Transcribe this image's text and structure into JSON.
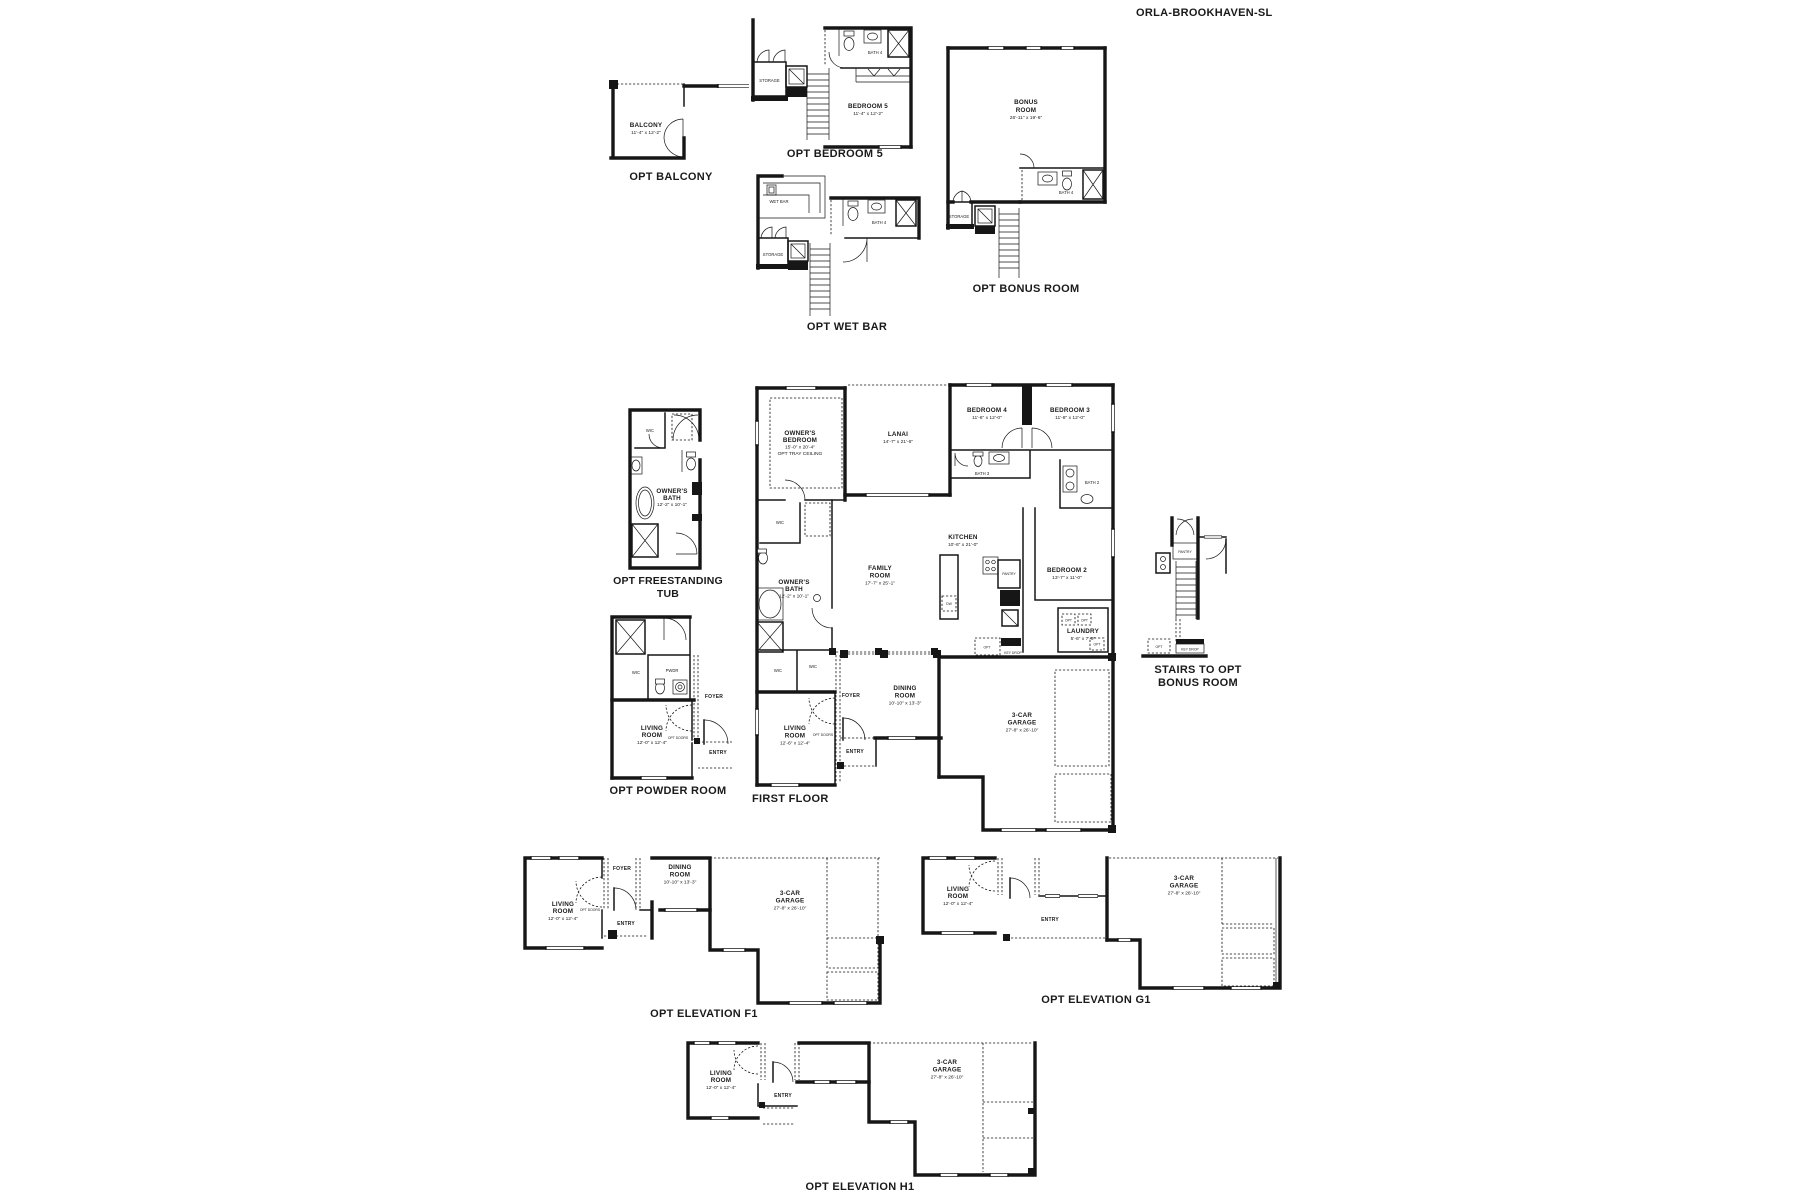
{
  "title": "ORLA-BROOKHAVEN-SL",
  "shared": {
    "storage": "STORAGE",
    "wic": "WIC",
    "opt": "OPT",
    "opt_doors": "OPT DOORS",
    "foyer": "FOYER",
    "entry": "ENTRY",
    "pantry": "PANTRY",
    "key_drop": "KEY DROP",
    "dw": "DW",
    "bath2": "BATH 2",
    "bath3": "BATH 3",
    "bath4": "BATH 4",
    "living1": "LIVING",
    "living2": "ROOM",
    "living_dims": "12'-0\" x 12'-4\"",
    "dining1": "DINING",
    "dining2": "ROOM",
    "dining_dims": "10'-10\" x 13'-3\"",
    "garage1": "3-CAR",
    "garage2": "GARAGE",
    "garage_dims": "27'-8\" x 26'-10\""
  },
  "sections": {
    "balcony": {
      "caption": "OPT BALCONY",
      "room": "BALCONY",
      "dims": "11'-4\" x 12'-2\""
    },
    "bedroom5": {
      "caption": "OPT BEDROOM 5",
      "room": "BEDROOM 5",
      "dims": "11'-4\" x 12'-2\""
    },
    "wetbar": {
      "caption": "OPT WET BAR",
      "room": "WET BAR"
    },
    "bonus": {
      "caption": "OPT BONUS ROOM",
      "room1": "BONUS",
      "room2": "ROOM",
      "dims": "26'-11\" x 19'-6\""
    },
    "tub": {
      "caption1": "OPT FREESTANDING",
      "caption2": "TUB",
      "room1": "OWNER'S",
      "room2": "BATH",
      "dims": "12'-2\" x 10'-1\""
    },
    "powder": {
      "caption": "OPT POWDER ROOM",
      "pwdr": "PWDR"
    },
    "first": {
      "caption": "FIRST FLOOR",
      "owners_bed1": "OWNER'S",
      "owners_bed2": "BEDROOM",
      "owners_bed_dims": "15'-0\" x 20'-4\"",
      "owners_bed_note": "OPT TRAY CEILING",
      "lanai": "LANAI",
      "lanai_dims": "14'-7\" x 21'-6\"",
      "bedroom4": "BEDROOM 4",
      "bedroom4_dims": "11'-6\" x 12'-0\"",
      "bedroom3": "BEDROOM 3",
      "bedroom3_dims": "11'-8\" x 12'-0\"",
      "bedroom2": "BEDROOM 2",
      "bedroom2_dims": "13'-7\" x 11'-0\"",
      "kitchen": "KITCHEN",
      "kitchen_dims": "10'-6\" x 21'-0\"",
      "family1": "FAMILY",
      "family2": "ROOM",
      "family_dims": "17'-7\" x 25'-1\"",
      "owners_bath1": "OWNER'S",
      "owners_bath2": "BATH",
      "owners_bath_dims": "12'-2\" x 10'-1\"",
      "laundry": "LAUNDRY",
      "laundry_dims": "5'-6\" x 7'-9\"",
      "living_dims": "12'-6\" x 12'-4\""
    },
    "stairs": {
      "caption1": "STAIRS TO OPT",
      "caption2": "BONUS ROOM"
    },
    "elevF1": {
      "caption": "OPT ELEVATION F1"
    },
    "elevG1": {
      "caption": "OPT ELEVATION G1"
    },
    "elevH1": {
      "caption": "OPT ELEVATION H1"
    }
  }
}
